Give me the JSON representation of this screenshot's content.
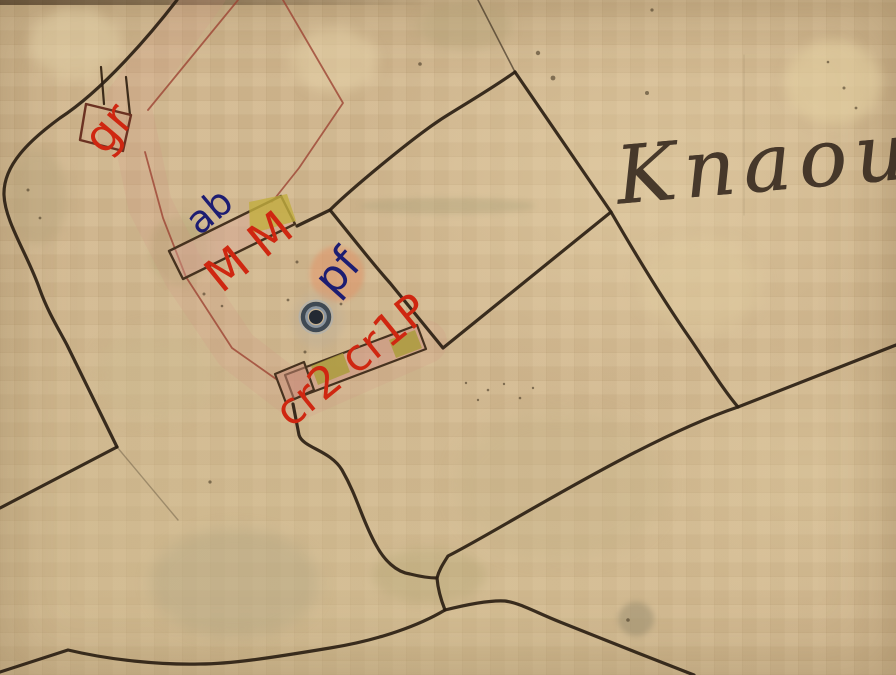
{
  "map": {
    "description": "historical cadastral map sheet with colored parcel annotations",
    "handwriting_text": "Knaou",
    "labels": {
      "gr": "gr",
      "ab": "ab",
      "mm": "M M",
      "pf": "pf",
      "cr": "cr2 cr1P"
    },
    "marker": "point-marker-icon",
    "colors": {
      "paper": "#d2b890",
      "ink": "#2b2014",
      "red_annotation": "#cf2711",
      "blue_annotation": "#1d1d72",
      "parcel_outline_red": "#9c4433",
      "building_yellow": "#c2ae3e",
      "building_pink": "#d8a898",
      "stamp_salmon": "#e09a70"
    }
  }
}
